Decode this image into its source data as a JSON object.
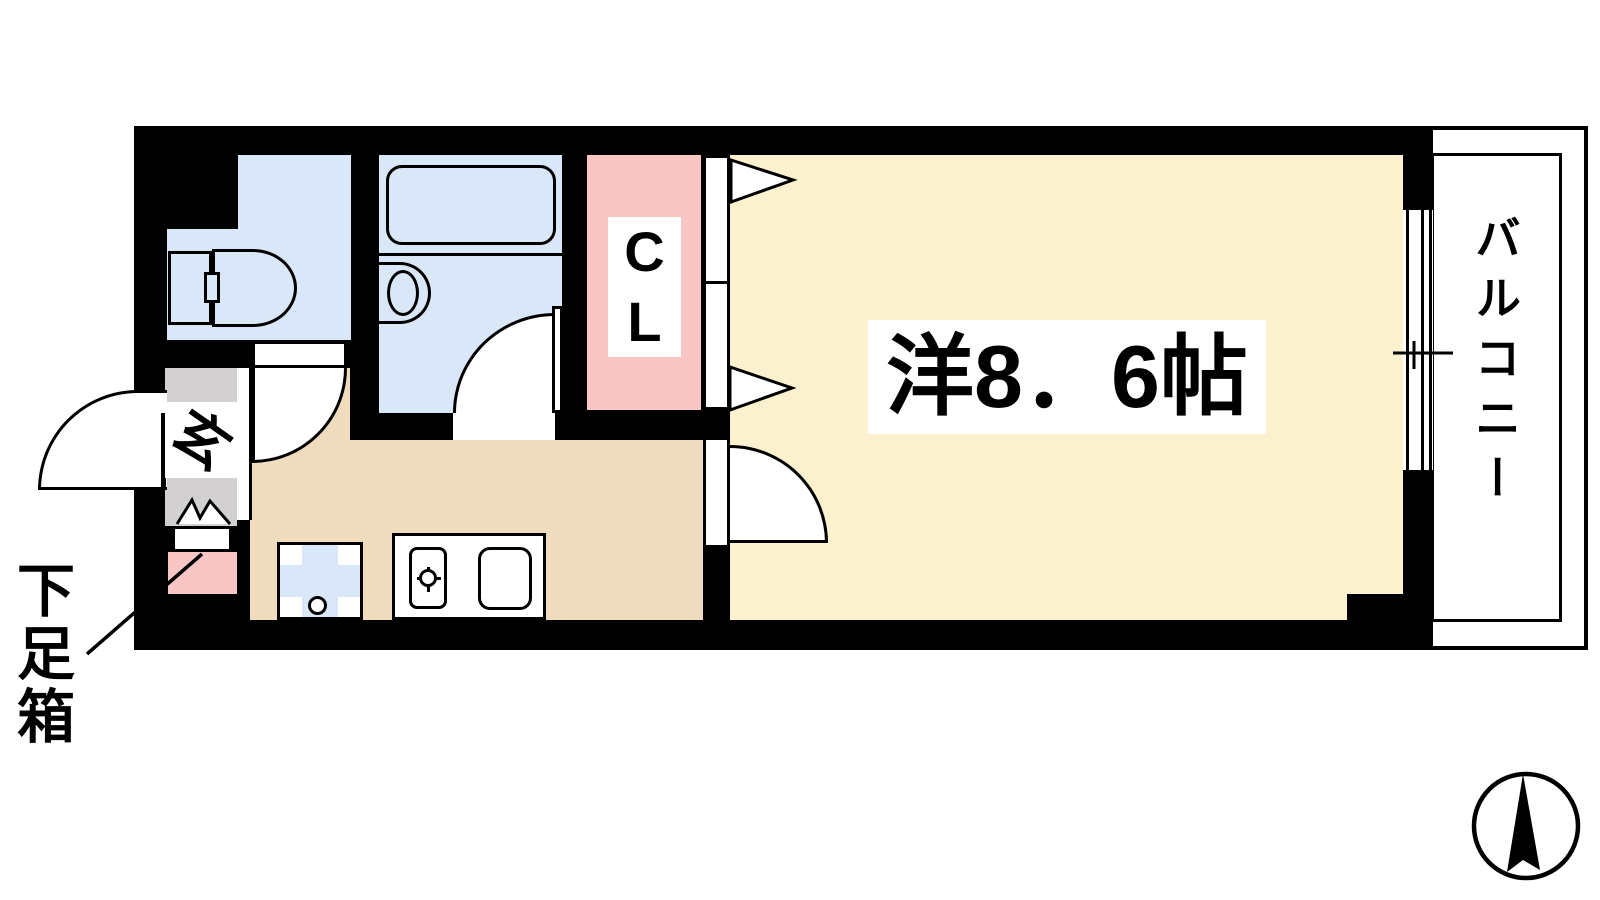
{
  "labels": {
    "main_room": "洋8．6帖",
    "closet_c": "C",
    "closet_l": "L",
    "entrance": "玄",
    "balcony": "バルコニー",
    "shoe_box": "下足箱"
  },
  "colors": {
    "wall": "#000000",
    "main_room": "#FBF1CF",
    "kitchen": "#EFDCBF",
    "wet_area": "#D9E7F8",
    "closet": "#F9C6C6",
    "entrance": "#D2D0D0",
    "line": "#000000",
    "paper": "#FFFFFF"
  },
  "icons": {
    "compass": "north-arrow",
    "fixtures": [
      "toilet",
      "bathtub",
      "washbasin",
      "stove-burner",
      "kitchen-sink",
      "washer-pan"
    ]
  }
}
